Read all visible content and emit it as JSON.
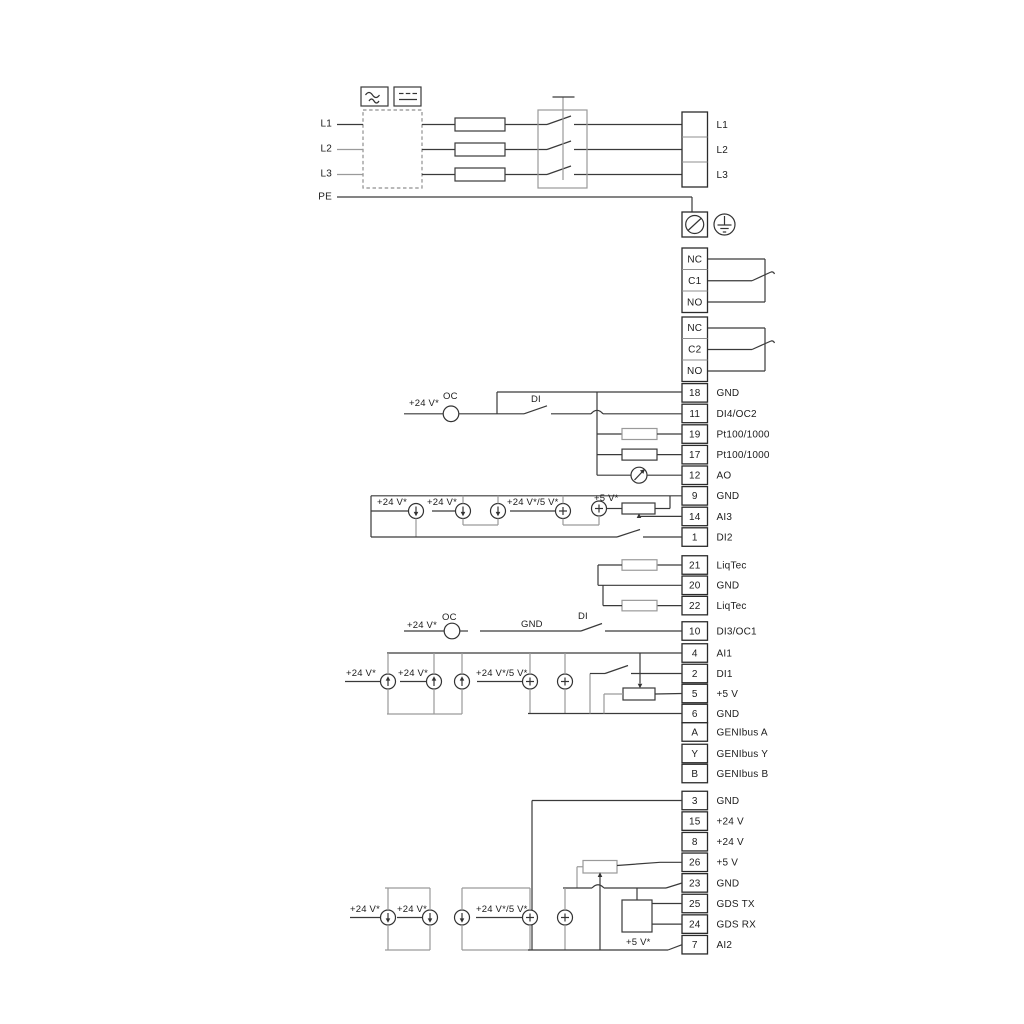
{
  "colors": {
    "wire": "#3a3a3a",
    "bracket": "#9a9a9a",
    "box_stroke": "#2b2b2b",
    "background": "#ffffff"
  },
  "left_labels": [
    "L1",
    "L2",
    "L3",
    "PE"
  ],
  "power_terminals": [
    "L1",
    "L2",
    "L3"
  ],
  "relay1": [
    "NC",
    "C1",
    "NO"
  ],
  "relay2": [
    "NC",
    "C2",
    "NO"
  ],
  "io_strip": [
    {
      "num": "18",
      "label": "GND"
    },
    {
      "num": "11",
      "label": "DI4/OC2"
    },
    {
      "num": "19",
      "label": "Pt100/1000"
    },
    {
      "num": "17",
      "label": "Pt100/1000"
    },
    {
      "num": "12",
      "label": "AO"
    },
    {
      "num": "9",
      "label": "GND"
    },
    {
      "num": "14",
      "label": "AI3"
    },
    {
      "num": "1",
      "label": "DI2"
    }
  ],
  "liqtec_strip": [
    {
      "num": "21",
      "label": "LiqTec"
    },
    {
      "num": "20",
      "label": "GND"
    },
    {
      "num": "22",
      "label": "LiqTec"
    }
  ],
  "ctrl_strip": [
    {
      "num": "10",
      "label": "DI3/OC1"
    },
    {
      "num": "4",
      "label": "AI1"
    },
    {
      "num": "2",
      "label": "DI1"
    },
    {
      "num": "5",
      "label": "+5 V"
    },
    {
      "num": "6",
      "label": "GND"
    },
    {
      "num": "A",
      "label": "GENIbus A"
    },
    {
      "num": "Y",
      "label": "GENIbus Y"
    },
    {
      "num": "B",
      "label": "GENIbus B"
    }
  ],
  "power_io_strip": [
    {
      "num": "3",
      "label": "GND"
    },
    {
      "num": "15",
      "label": "+24 V"
    },
    {
      "num": "8",
      "label": "+24 V"
    },
    {
      "num": "26",
      "label": "+5 V"
    },
    {
      "num": "23",
      "label": "GND"
    },
    {
      "num": "25",
      "label": "GDS TX"
    },
    {
      "num": "24",
      "label": "GDS RX"
    },
    {
      "num": "7",
      "label": "AI2"
    }
  ],
  "labels": {
    "v24_top": "+24 V*",
    "oc_top": "OC",
    "di_top": "DI",
    "v24_mid": "+24 V*",
    "oc_mid": "OC",
    "gnd_mid": "GND",
    "di_mid": "DI",
    "ai3_v24_a": "+24 V*",
    "ai3_v24_b": "+24 V*",
    "ai3_v24_5": "+24 V*/5 V*",
    "ai3_v5": "+5 V*",
    "ai1_v24_a": "+24 V*",
    "ai1_v24_b": "+24 V*",
    "ai1_v24_5": "+24 V*/5 V*",
    "ai2_v24_a": "+24 V*",
    "ai2_v24_b": "+24 V*",
    "ai2_v24_5": "+24 V*/5 V*",
    "ai2_v5": "+5 V*"
  }
}
